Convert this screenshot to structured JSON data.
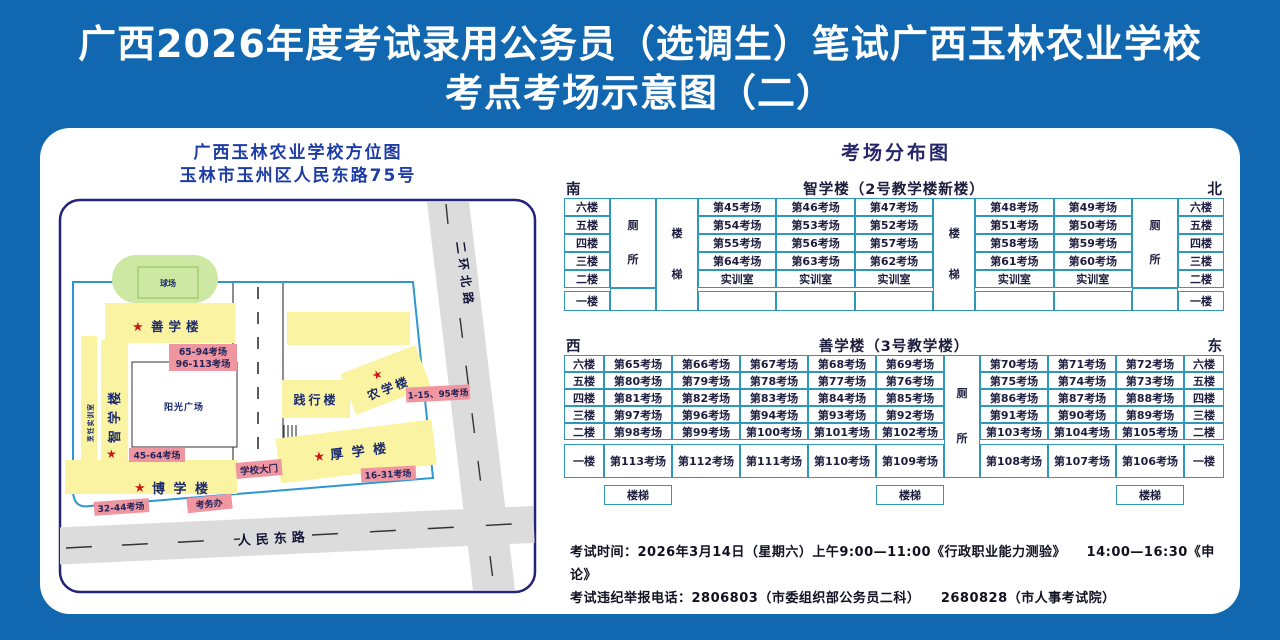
{
  "page": {
    "title_line1": "广西2026年度考试录用公务员（选调生）笔试广西玉林农业学校",
    "title_line2": "考点考场示意图（二）"
  },
  "map": {
    "title_line1": "广西玉林农业学校方位图",
    "title_line2": "玉林市玉州区人民东路75号",
    "star": "★",
    "buildings": {
      "qiuchang": "球场",
      "shanxuelou": "善学楼",
      "zhixuelou": "智学楼",
      "pengren": "烹饪实训室",
      "yangguang": "阳光广场",
      "boxuelou": "博 学 楼",
      "houxuelou": "厚 学 楼",
      "jianxinglou": "践行楼",
      "nongxuelou": "农学楼"
    },
    "labels": {
      "shan_rooms_1": "65-94考场",
      "shan_rooms_2": "96-113考场",
      "zhi_rooms": "45-64考场",
      "bo_rooms": "32-44考场",
      "kaowuban": "考务办",
      "gate": "学校大门",
      "hou_rooms": "16-31考场",
      "nong_rooms": "1-15、95考场"
    },
    "roads": {
      "renmin": "人民东路",
      "erhuan": "二环北路"
    }
  },
  "dist": {
    "header": "考场分布图",
    "t1": {
      "compass_left": "南",
      "compass_right": "北",
      "title": "智学楼（2号教学楼新楼）",
      "floors": [
        "六楼",
        "五楼",
        "四楼",
        "三楼",
        "二楼",
        "一楼"
      ],
      "toilet": "厕所",
      "stairs": "楼梯",
      "left_rooms": [
        [
          "第45考场",
          "第46考场",
          "第47考场"
        ],
        [
          "第54考场",
          "第53考场",
          "第52考场"
        ],
        [
          "第55考场",
          "第56考场",
          "第57考场"
        ],
        [
          "第64考场",
          "第63考场",
          "第62考场"
        ],
        [
          "实训室",
          "实训室",
          "实训室"
        ],
        [
          "",
          "",
          ""
        ]
      ],
      "right_rooms": [
        [
          "第48考场",
          "第49考场"
        ],
        [
          "第51考场",
          "第50考场"
        ],
        [
          "第58考场",
          "第59考场"
        ],
        [
          "第61考场",
          "第60考场"
        ],
        [
          "实训室",
          "实训室"
        ],
        [
          "",
          ""
        ]
      ]
    },
    "t2": {
      "compass_left": "西",
      "compass_right": "东",
      "title": "善学楼（3号教学楼）",
      "floors": [
        "六楼",
        "五楼",
        "四楼",
        "三楼",
        "二楼",
        "一楼"
      ],
      "toilet": "厕所",
      "stairs": "楼梯",
      "left_rooms": [
        [
          "第65考场",
          "第66考场",
          "第67考场",
          "第68考场",
          "第69考场"
        ],
        [
          "第80考场",
          "第79考场",
          "第78考场",
          "第77考场",
          "第76考场"
        ],
        [
          "第81考场",
          "第82考场",
          "第83考场",
          "第84考场",
          "第85考场"
        ],
        [
          "第97考场",
          "第96考场",
          "第94考场",
          "第93考场",
          "第92考场"
        ],
        [
          "第98考场",
          "第99考场",
          "第100考场",
          "第101考场",
          "第102考场"
        ],
        [
          "第113考场",
          "第112考场",
          "第111考场",
          "第110考场",
          "第109考场"
        ]
      ],
      "right_rooms": [
        [
          "第70考场",
          "第71考场",
          "第72考场"
        ],
        [
          "第75考场",
          "第74考场",
          "第73考场"
        ],
        [
          "第86考场",
          "第87考场",
          "第88考场"
        ],
        [
          "第91考场",
          "第90考场",
          "第89考场"
        ],
        [
          "第103考场",
          "第104考场",
          "第105考场"
        ],
        [
          "第108考场",
          "第107考场",
          "第106考场"
        ]
      ]
    }
  },
  "notes": {
    "line1": "考试时间：2026年3月14日（星期六）上午9:00—11:00《行政职业能力测验》　　14:00—16:30《申论》",
    "line2": "考试违纪举报电话：2806803（市委组织部公务员二科）　　2680828（市人事考试院）"
  },
  "colors": {
    "background_blue": "#1268b0",
    "table_border_teal": "#2f97ba",
    "building_yellow": "#faf3a2",
    "field_green": "#cde8a2",
    "label_pink": "#ef96a1",
    "star_red": "#d11818",
    "road_gray": "#dcdcdc",
    "navy_text": "#26266a"
  }
}
